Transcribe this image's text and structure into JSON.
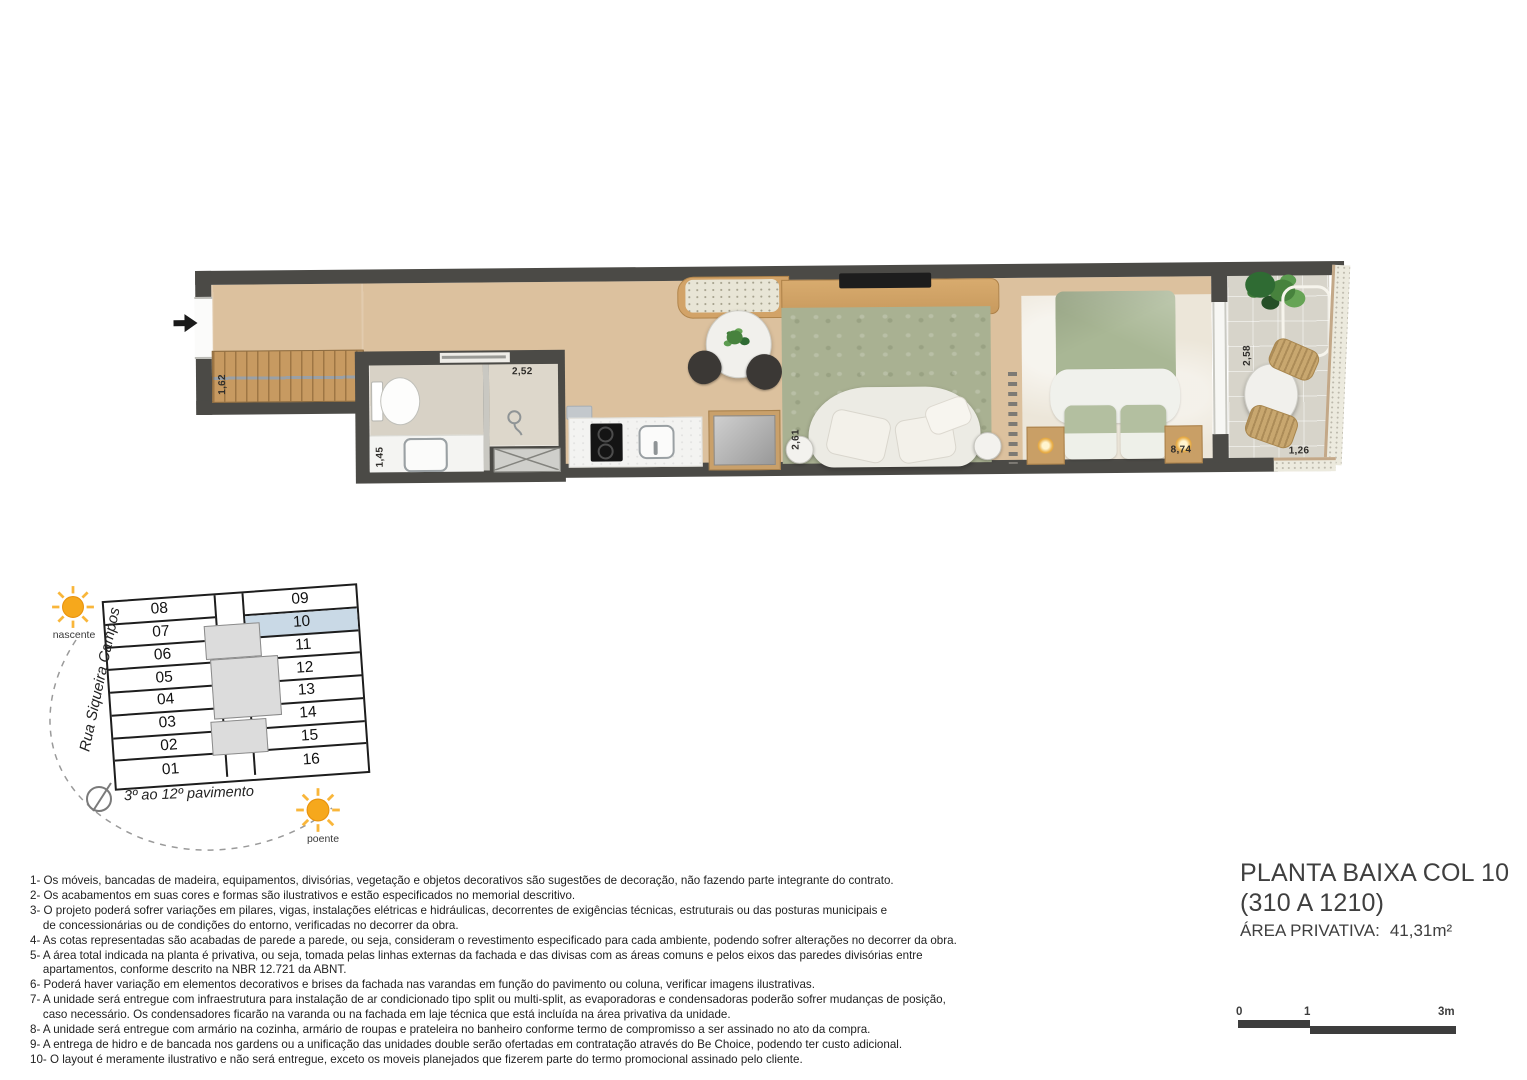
{
  "plan": {
    "dims": {
      "closet": "1,62",
      "bath": "1,45",
      "shower": "2,52",
      "living": "2,61",
      "bedroom": "8,74",
      "balcony_depth": "2,58",
      "balcony_width": "1,26"
    },
    "wall_color": "#4b4a46",
    "floor_wood_color": "#dcc19e",
    "rug_color": "#a9b192",
    "duvet_color": "#a9b795"
  },
  "key_plan": {
    "street": "Rua Siqueira Campos",
    "floors": "3º ao 12º pavimento",
    "left_units": [
      "08",
      "07",
      "06",
      "05",
      "04",
      "03",
      "02",
      "01"
    ],
    "right_units": [
      "09",
      "10",
      "11",
      "12",
      "13",
      "14",
      "15",
      "16"
    ],
    "highlighted_unit": "10",
    "highlight_color": "#c9d9e6",
    "sun_east_label": "nascente",
    "sun_west_label": "poente",
    "sun_color": "#f6a81c"
  },
  "notes": [
    "1- Os móveis, bancadas de madeira, equipamentos, divisórias, vegetação e objetos decorativos são sugestões de decoração, não fazendo parte integrante do contrato.",
    "2- Os acabamentos em suas cores e formas são ilustrativos e estão especificados no memorial descritivo.",
    "3- O projeto poderá sofrer variações em pilares, vigas, instalações elétricas e hidráulicas, decorrentes de exigências técnicas, estruturais ou das posturas municipais e\n    de concessionárias ou de condições do entorno, verificadas no decorrer da obra.",
    "4- As cotas representadas são acabadas de parede a parede, ou seja, consideram o revestimento especificado para cada ambiente, podendo sofrer alterações no decorrer da obra.",
    "5- A área total indicada na planta é privativa, ou seja, tomada pelas linhas externas da fachada e das divisas com as áreas comuns e pelos eixos das paredes divisórias entre\n    apartamentos, conforme descrito na NBR 12.721 da ABNT.",
    "6- Poderá haver variação em elementos decorativos e brises da fachada nas varandas em função do pavimento ou coluna, verificar imagens ilustrativas.",
    "7- A unidade será entregue com infraestrutura para instalação de ar condicionado tipo split ou multi-split, as evaporadoras e condensadoras poderão sofrer mudanças de posição,\n    caso necessário. Os condensadores ficarão na varanda ou na fachada em laje técnica que está incluída na área privativa da unidade.",
    "8- A unidade será entregue com armário na cozinha, armário de roupas e prateleira no banheiro conforme termo de compromisso a ser assinado no ato da compra.",
    "9- A entrega de hidro e de bancada nos gardens ou a unificação das unidades double serão ofertadas em contratação através do Be Choice, podendo ter custo adicional.",
    "10- O layout é meramente ilustrativo e não será entregue, exceto os moveis planejados que fizerem parte do termo promocional assinado pelo cliente."
  ],
  "title_block": {
    "line1": "PLANTA BAIXA COL 10",
    "line2": "(310 A 1210)",
    "area_label": "ÁREA PRIVATIVA:",
    "area_value": "41,31m²"
  },
  "scale_bar": {
    "t0": "0",
    "t1": "1",
    "t2": "3m"
  }
}
